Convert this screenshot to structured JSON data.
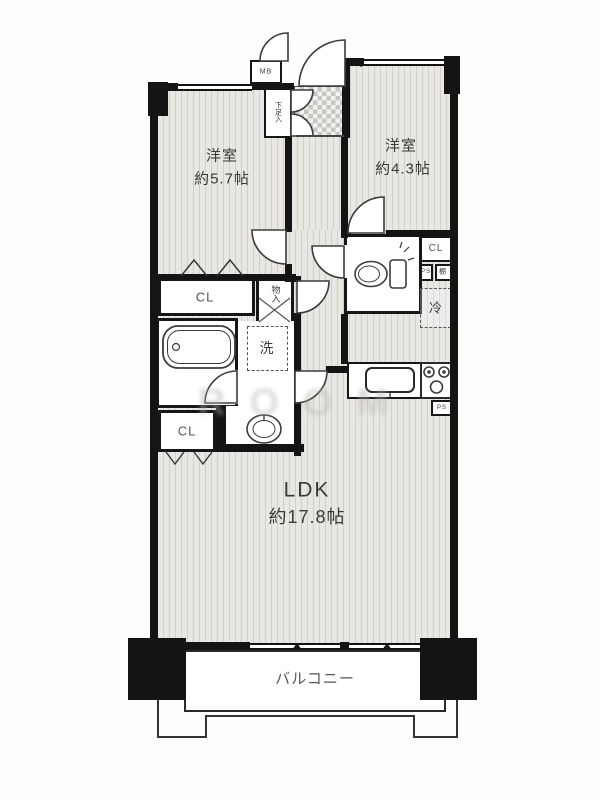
{
  "plan": {
    "rooms": {
      "bedroom1": {
        "name": "洋室",
        "size": "約5.7帖"
      },
      "bedroom2": {
        "name": "洋室",
        "size": "約4.3帖"
      },
      "ldk": {
        "name": "LDK",
        "size": "約17.8帖"
      },
      "balcony": "バルコニー"
    },
    "labels": {
      "closet_bedroom1": "CL",
      "closet_washroom": "CL",
      "closet_hall": "CL",
      "storage": "物入",
      "shoe_cabinet": "下足入",
      "meter_box": "MB",
      "washing_machine": "洗",
      "refrigerator": "冷",
      "shelf": "棚",
      "pipe_space_hall": "PS",
      "pipe_space_kitchen": "PS"
    },
    "watermark": "ROOM",
    "colors": {
      "wall": "#141414",
      "floor": "#e9e7e4",
      "floor_stripe": "#d2cfcb",
      "tile": "#c8c6c2",
      "line": "#3c3c3c"
    }
  }
}
